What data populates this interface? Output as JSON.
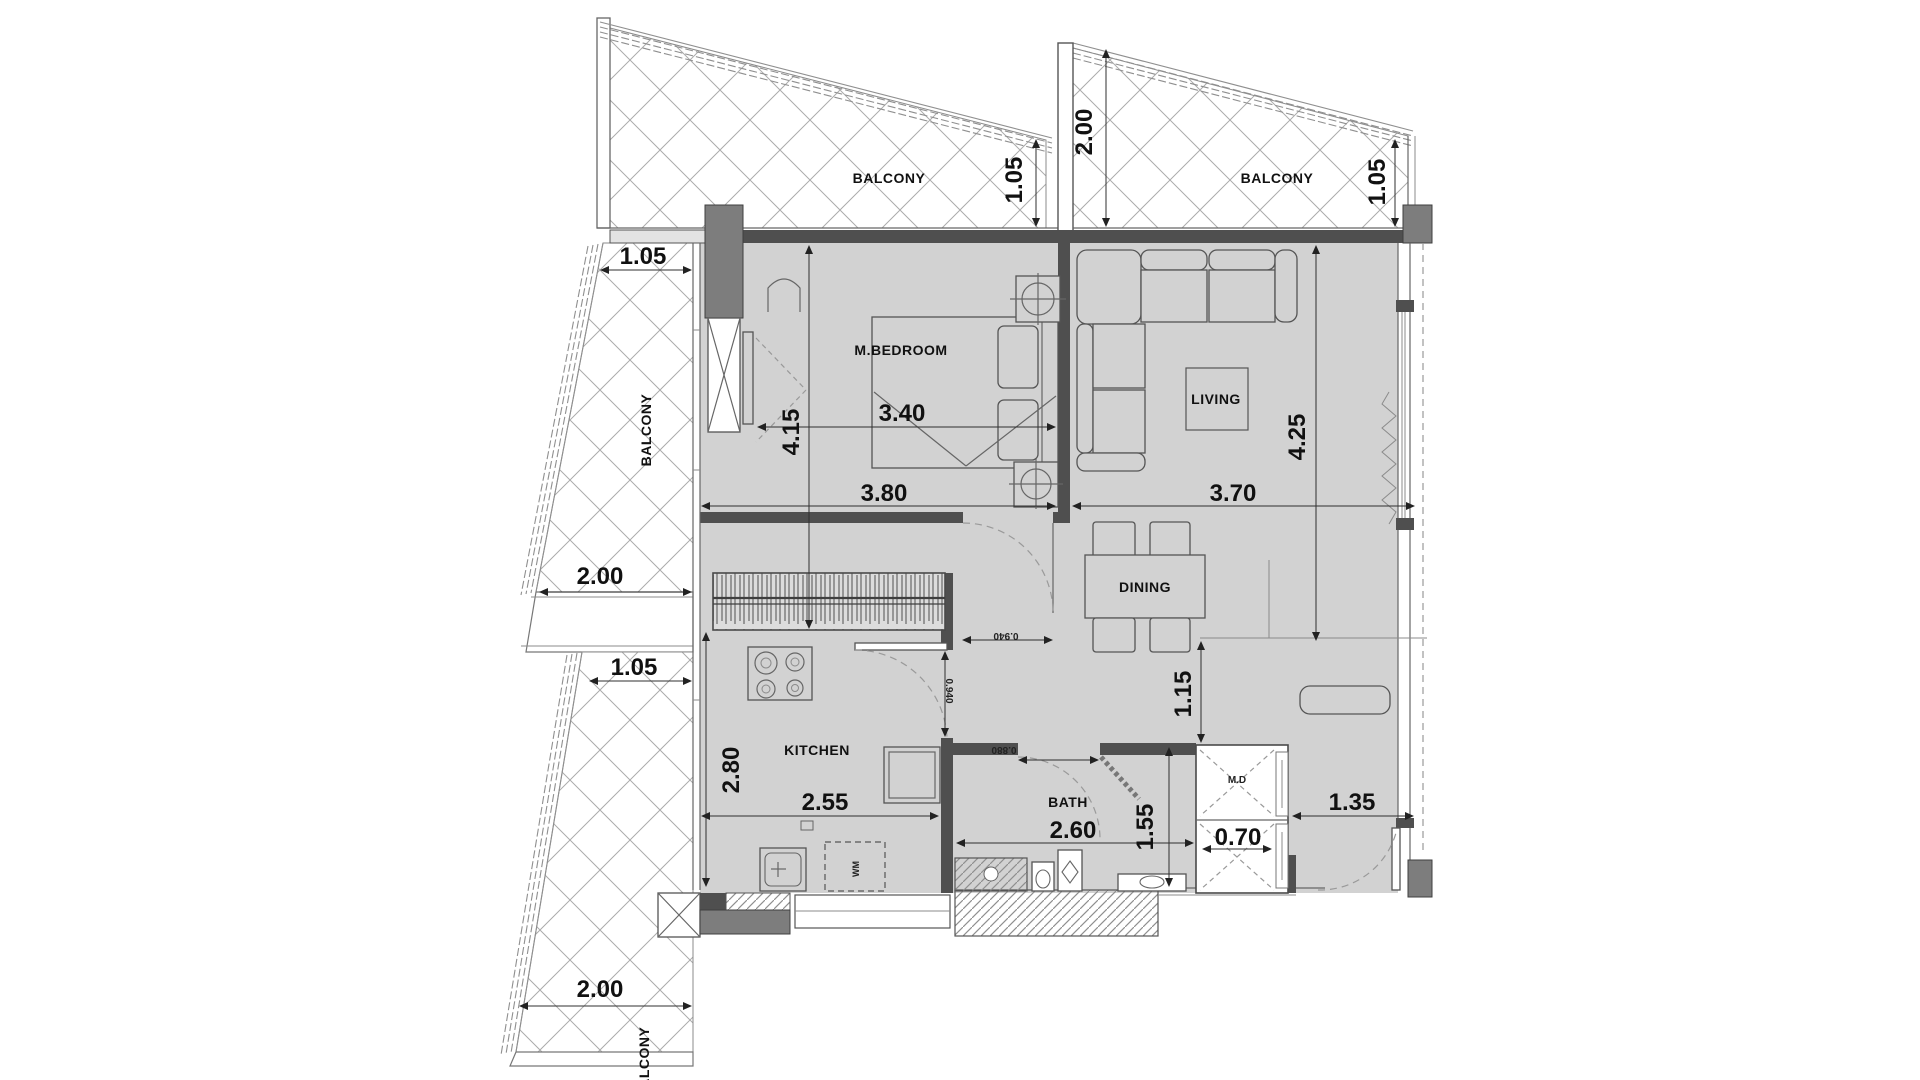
{
  "plan": {
    "balconies": {
      "top_left_label": "BALCONY",
      "top_right_label": "BALCONY",
      "left_upper_label": "BALCONY",
      "left_lower_label": "BALCONY"
    },
    "rooms": {
      "bedroom": "M.BEDROOM",
      "living": "LIVING",
      "dining": "DINING",
      "kitchen": "KITCHEN",
      "bath": "BATH",
      "maid_closet": "M.D",
      "washer": "WM"
    },
    "dims": {
      "tl_balcony_depth": "1.05",
      "top_gap_depth": "2.00",
      "tr_balcony_depth": "1.05",
      "left_balcony_top_w": "1.05",
      "left_balcony_mid": "2.00",
      "left_balcony_lower_w": "1.05",
      "left_balcony_bottom": "2.00",
      "bedroom_w": "3.40",
      "bedroom_h": "4.15",
      "span_left": "3.80",
      "span_right": "3.70",
      "living_h": "4.25",
      "hall_h": "1.15",
      "kitchen_h": "2.80",
      "kitchen_w": "2.55",
      "bath_w": "2.60",
      "bath_h": "1.55",
      "md_w": "0.70",
      "entry_w": "1.35",
      "door_bedroom": "0.940",
      "door_kitchen": "0.940",
      "door_bath": "0.880"
    },
    "colors": {
      "floor": "#d2d2d2",
      "wall": "#4f4f4f",
      "column": "#7d7d7d"
    }
  }
}
